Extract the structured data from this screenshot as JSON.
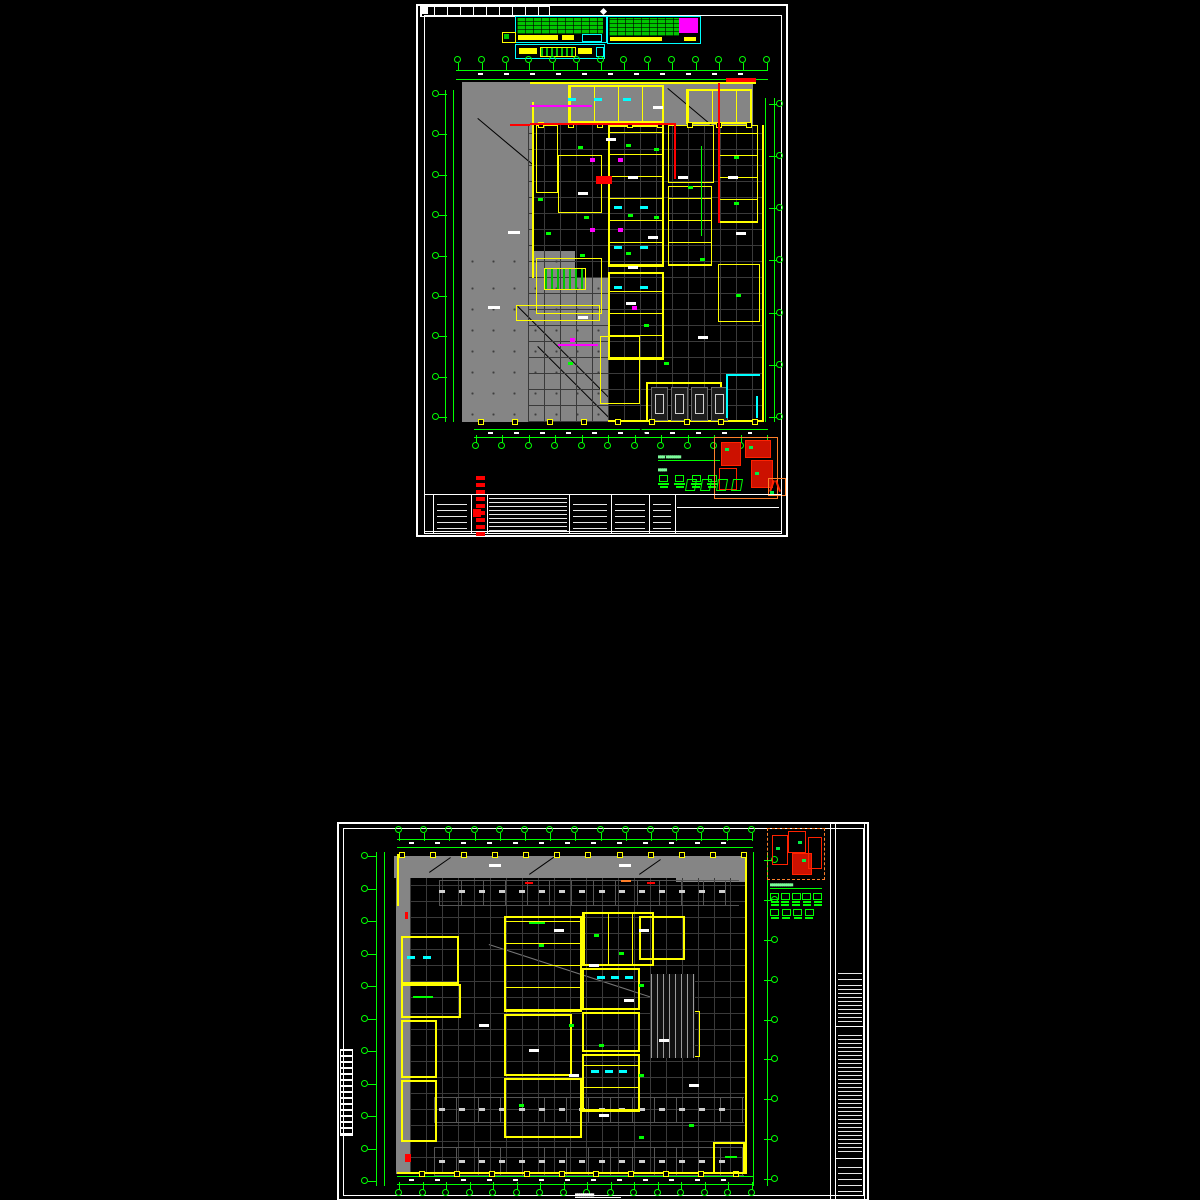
{
  "palette": {
    "background": "#000000",
    "paper_border": "#ffffff",
    "dimension_green": "#00ff00",
    "wall_yellow": "#ffff00",
    "schedule_cyan": "#00ffff",
    "pipe_red": "#ff0000",
    "highlight_magenta": "#ff00ff",
    "keyplan_orange": "#ff7f2a",
    "fill_gray": "#858585"
  },
  "sheet_top": {
    "name": "upper-plan-sheet",
    "plan_title_glyphs": "▄▄▄—▄▄▄▄▄▄▄",
    "legend_heading_glyphs": "▄▄▄▄",
    "legend_item_count": 4,
    "grid_bubbles": {
      "top": 14,
      "bottom": 12,
      "left": 9,
      "right": 7
    },
    "column_squares": {
      "top_row": 8,
      "bottom_row": 9
    },
    "elevator_count": 4,
    "stamp_icon_count": 4,
    "header_tables": {
      "count": 3,
      "accent_block_color": "#ff00ff"
    }
  },
  "sheet_bottom": {
    "name": "lower-plan-sheet",
    "plan_title_glyphs": "▄▄▄▄▄▄▄▄▄▄▄",
    "legend_item_count": 5,
    "legend_row2_count": 4,
    "caption_glyphs": "▄▄▄▄▄▄▄▄▄",
    "grid_bubbles": {
      "top": 15,
      "bottom": 16,
      "left": 11,
      "right": 9
    },
    "column_squares": {
      "top_row": 12,
      "bottom_row": 10
    },
    "keyplan_style": "dashed-orange"
  }
}
